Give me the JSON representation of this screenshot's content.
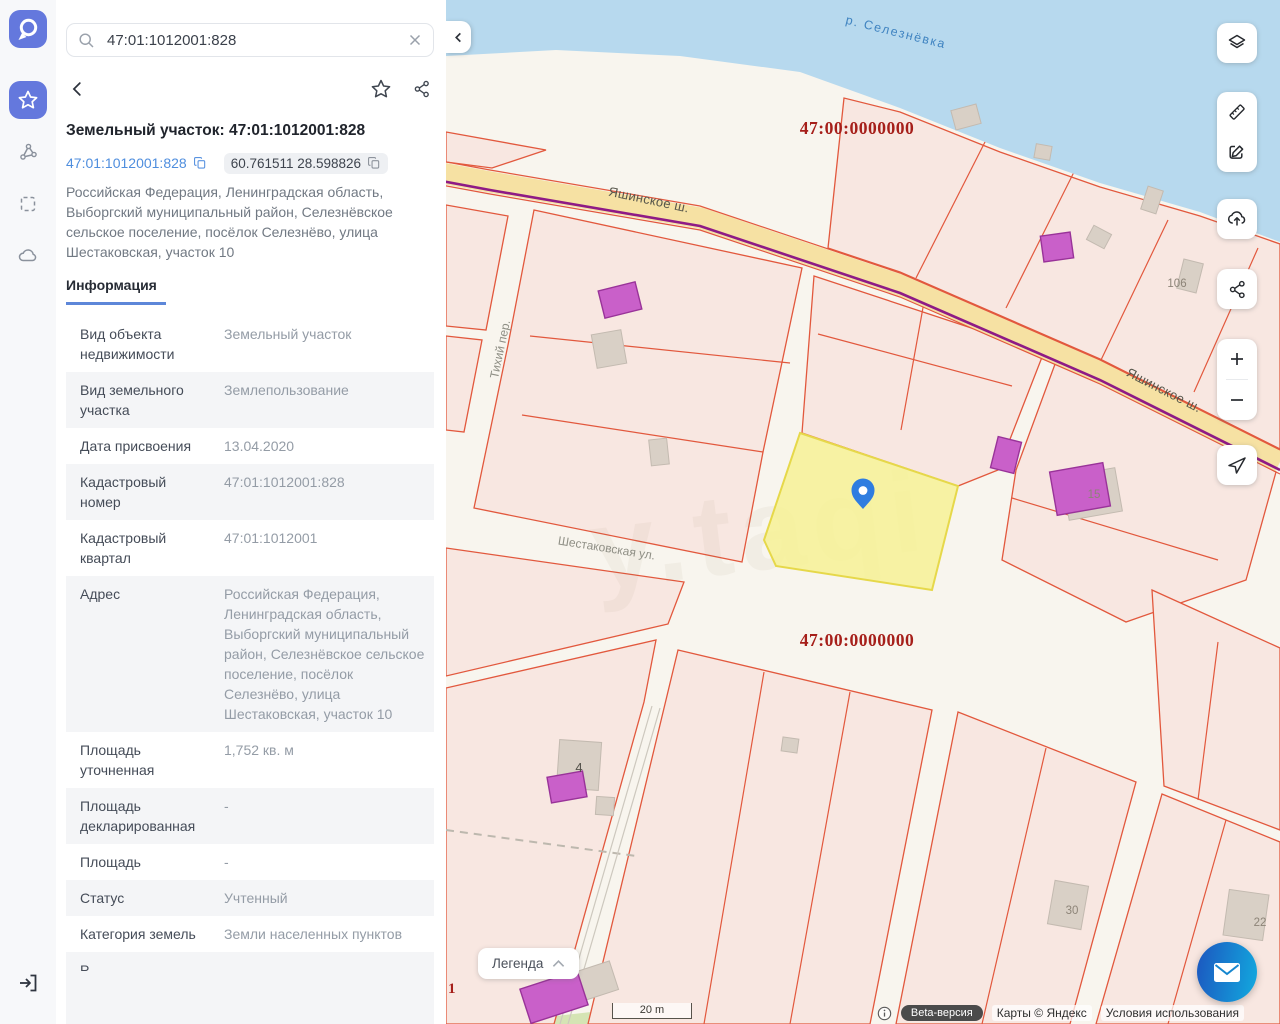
{
  "sidebar": {
    "search": {
      "value": "47:01:1012001:828"
    },
    "title": "Земельный участок: 47:01:1012001:828",
    "chips": {
      "cadastral": "47:01:1012001:828",
      "coordinates": "60.761511 28.598826"
    },
    "address": "Российская Федерация, Ленинградская область, Выборгский муниципальный район, Селезнёвское сельское поселение, посёлок Селезнёво, улица Шестаковская, участок 10",
    "tab": "Информация",
    "info_rows": [
      {
        "label": "Вид объекта недвижимости",
        "value": "Земельный участок"
      },
      {
        "label": "Вид земельного участка",
        "value": "Землепользование"
      },
      {
        "label": "Дата присвоения",
        "value": "13.04.2020"
      },
      {
        "label": "Кадастровый номер",
        "value": "47:01:1012001:828"
      },
      {
        "label": "Кадастровый квартал",
        "value": "47:01:1012001"
      },
      {
        "label": "Адрес",
        "value": "Российская Федерация, Ленинградская область, Выборгский муниципальный район, Селезнёвское сельское поселение, посёлок Селезнёво, улица Шестаковская, участок 10"
      },
      {
        "label": "Площадь уточненная",
        "value": "1,752 кв. м"
      },
      {
        "label": "Площадь декларированная",
        "value": "-"
      },
      {
        "label": "Площадь",
        "value": "-"
      },
      {
        "label": "Статус",
        "value": "Учтенный"
      },
      {
        "label": "Категория земель",
        "value": "Земли населенных пунктов"
      }
    ],
    "partial_row_label": "Р"
  },
  "map": {
    "labels": {
      "river": "р. Селезнёвка",
      "quarter": "47:00:0000000",
      "road": "Яшинское ш.",
      "street_shestakovskaya": "Шестаковская ул.",
      "street_tikhiy": "Тихий пер.",
      "house_106": "106",
      "house_15": "15",
      "house_4": "4",
      "house_30": "30",
      "house_22": "22",
      "partial_number": "1"
    },
    "legend_button": "Легенда",
    "scale": "20 m",
    "attribution": {
      "beta": "Beta-версия",
      "copyright": "Карты © Яндекс",
      "terms": "Условия использования"
    }
  },
  "icons": {
    "rail": [
      "app-logo",
      "favorites-star",
      "vector-polygon",
      "select-area",
      "cloud",
      "login"
    ],
    "map_controls": [
      "layers",
      "ruler",
      "edit",
      "cloud-upload",
      "share",
      "zoom-in",
      "zoom-out",
      "locate"
    ]
  },
  "colors": {
    "accent_blue": "#6478dd",
    "parcel_fill": "#f8e7e1",
    "parcel_stroke": "#e2583d",
    "selected_parcel_fill": "#f7f193",
    "selected_parcel_stroke": "#e6d84a",
    "river": "#b7d9ee",
    "road_fill": "#f6e1a3",
    "road_purple_line": "#8e1a86",
    "quarter_label": "#a61f1a",
    "building_purple": "#c960c9",
    "building_grey": "#d9d0c6",
    "pin_blue": "#2f7de0",
    "chat_gradient": [
      "#1b5ec2",
      "#13a2dc"
    ]
  }
}
